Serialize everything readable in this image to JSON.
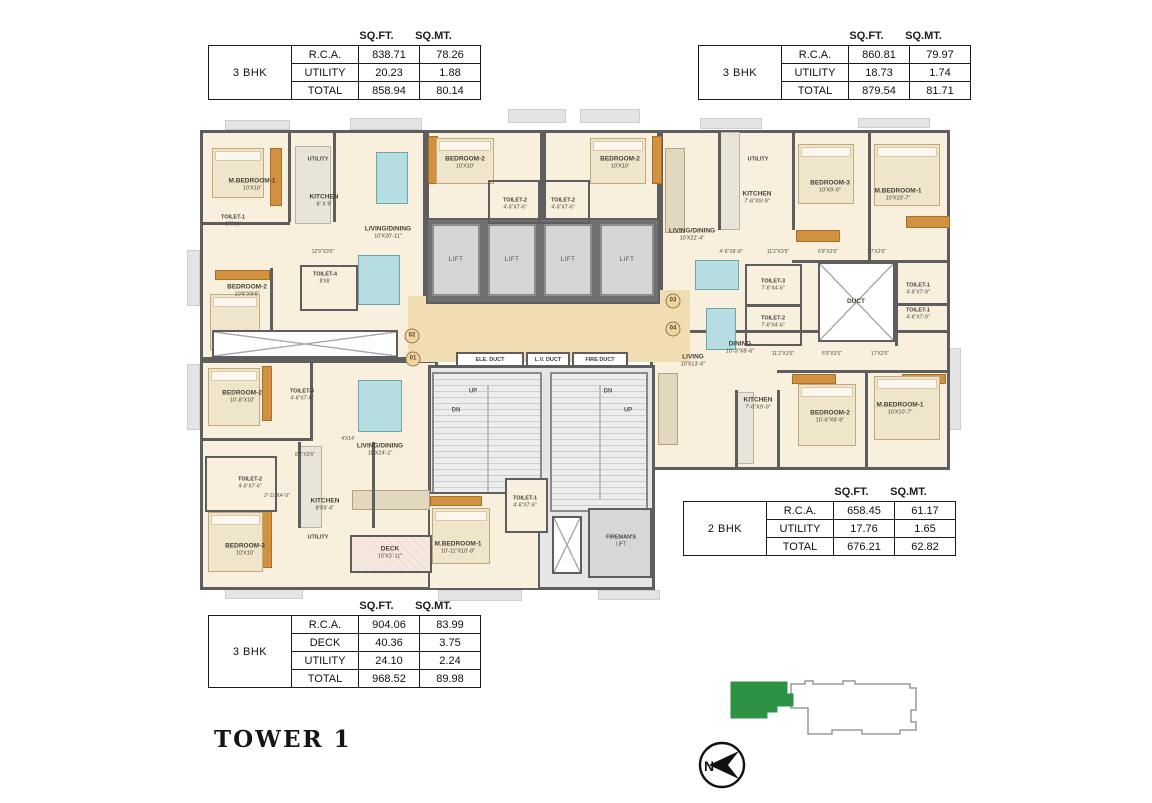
{
  "title": "TOWER 1",
  "compass": {
    "label": "N"
  },
  "colors": {
    "keyplan_green": "#2e9245",
    "wall_gray": "#5e5e5e",
    "lobby_tan": "#f0ddb2"
  },
  "tables": [
    {
      "unit": "3 BHK",
      "headers": [
        "SQ.FT.",
        "SQ.MT."
      ],
      "rows": [
        [
          "R.C.A.",
          "838.71",
          "78.26"
        ],
        [
          "UTILITY",
          "20.23",
          "1.88"
        ],
        [
          "TOTAL",
          "858.94",
          "80.14"
        ]
      ]
    },
    {
      "unit": "3 BHK",
      "headers": [
        "SQ.FT.",
        "SQ.MT."
      ],
      "rows": [
        [
          "R.C.A.",
          "860.81",
          "79.97"
        ],
        [
          "UTILITY",
          "18.73",
          "1.74"
        ],
        [
          "TOTAL",
          "879.54",
          "81.71"
        ]
      ]
    },
    {
      "unit": "2 BHK",
      "headers": [
        "SQ.FT.",
        "SQ.MT."
      ],
      "rows": [
        [
          "R.C.A.",
          "658.45",
          "61.17"
        ],
        [
          "UTILITY",
          "17.76",
          "1.65"
        ],
        [
          "TOTAL",
          "676.21",
          "62.82"
        ]
      ]
    },
    {
      "unit": "3 BHK",
      "headers": [
        "SQ.FT.",
        "SQ.MT."
      ],
      "rows": [
        [
          "R.C.A.",
          "904.06",
          "83.99"
        ],
        [
          "DECK",
          "40.36",
          "3.75"
        ],
        [
          "UTILITY",
          "24.10",
          "2.24"
        ],
        [
          "TOTAL",
          "968.52",
          "89.98"
        ]
      ]
    }
  ],
  "floorplan": {
    "lift_label": "LIFT",
    "ducts": [
      "ELE. DUCT",
      "L.V. DUCT",
      "FIRE DUCT"
    ],
    "labels": [
      {
        "x": 52,
        "y": 67,
        "a": "M.BEDROOM-1",
        "b": "10'X10'"
      },
      {
        "x": 118,
        "y": 42,
        "a": "UTILITY",
        "c": "small"
      },
      {
        "x": 124,
        "y": 83,
        "a": "KITCHEN",
        "b": "8' X 9'"
      },
      {
        "x": 33,
        "y": 103,
        "a": "TOILET-1",
        "b": "6'7\"X4'",
        "c": "small"
      },
      {
        "x": 188,
        "y": 115,
        "a": "LIVING/DINING",
        "b": "10'X20'-11\""
      },
      {
        "x": 123,
        "y": 134,
        "a": "12'9\"X3'6\"",
        "c": "dim"
      },
      {
        "x": 47,
        "y": 173,
        "a": "BEDROOM-2",
        "b": "10'9\"X9'6\""
      },
      {
        "x": 125,
        "y": 160,
        "a": "TOILET-4",
        "b": "8'X6'",
        "c": "small"
      },
      {
        "x": 265,
        "y": 45,
        "a": "BEDROOM-2",
        "b": "10'X10'"
      },
      {
        "x": 315,
        "y": 86,
        "a": "TOILET-2",
        "b": "4'-5\"X7'-6\"",
        "c": "small"
      },
      {
        "x": 363,
        "y": 86,
        "a": "TOILET-2",
        "b": "4'-5\"X7'-6\"",
        "c": "small"
      },
      {
        "x": 420,
        "y": 45,
        "a": "BEDROOM-2",
        "b": "10'X10'"
      },
      {
        "x": 492,
        "y": 117,
        "a": "LIVING/DINING",
        "b": "10'X22'-4\""
      },
      {
        "x": 558,
        "y": 42,
        "a": "UTILITY",
        "c": "small"
      },
      {
        "x": 557,
        "y": 80,
        "a": "KITCHEN",
        "b": "7'-6\"X9'-9\""
      },
      {
        "x": 630,
        "y": 69,
        "a": "BEDROOM-3",
        "b": "10'X9'-9\""
      },
      {
        "x": 698,
        "y": 77,
        "a": "M.BEDROOM-1",
        "b": "10'X10'-7\""
      },
      {
        "x": 531,
        "y": 134,
        "a": "4'-6\"X8'-8\"",
        "c": "dim"
      },
      {
        "x": 578,
        "y": 134,
        "a": "11'2\"X3'5\"",
        "c": "dim"
      },
      {
        "x": 628,
        "y": 134,
        "a": "6'9\"X3'5\"",
        "c": "dim"
      },
      {
        "x": 677,
        "y": 134,
        "a": "17'X2'6\"",
        "c": "dim"
      },
      {
        "x": 573,
        "y": 167,
        "a": "TOILET-3",
        "b": "7'-6\"X4'-6\"",
        "c": "small"
      },
      {
        "x": 573,
        "y": 204,
        "a": "TOILET-2",
        "b": "7'-6\"X4'-6\"",
        "c": "small"
      },
      {
        "x": 656,
        "y": 184,
        "a": "DUCT"
      },
      {
        "x": 718,
        "y": 171,
        "a": "TOILET-1",
        "b": "4'-6\"X7'-9\"",
        "c": "small"
      },
      {
        "x": 718,
        "y": 196,
        "a": "TOILET-1",
        "b": "4'-6\"X7'-9\"",
        "c": "small"
      },
      {
        "x": 493,
        "y": 243,
        "a": "LIVING",
        "b": "10'X13'-6\""
      },
      {
        "x": 540,
        "y": 230,
        "a": "DINING",
        "b": "10'-3\"X8'-6\""
      },
      {
        "x": 583,
        "y": 236,
        "a": "11'2\"X3'5\"",
        "c": "dim"
      },
      {
        "x": 632,
        "y": 236,
        "a": "6'9\"X3'5\"",
        "c": "dim"
      },
      {
        "x": 680,
        "y": 236,
        "a": "17'X2'6\"",
        "c": "dim"
      },
      {
        "x": 558,
        "y": 286,
        "a": "KITCHEN",
        "b": "7'-6\"X9'-9\""
      },
      {
        "x": 630,
        "y": 299,
        "a": "BEDROOM-2",
        "b": "10'-6\"X9'-9\""
      },
      {
        "x": 700,
        "y": 291,
        "a": "M.BEDROOM-1",
        "b": "10'X10'-7\""
      },
      {
        "x": 42,
        "y": 279,
        "a": "BEDROOM-2",
        "b": "10'-8\"X10'"
      },
      {
        "x": 102,
        "y": 277,
        "a": "TOILET-3",
        "b": "4'-6\"X7'-6\"",
        "c": "small"
      },
      {
        "x": 180,
        "y": 332,
        "a": "LIVING/DINING",
        "b": "10'X24'-1\""
      },
      {
        "x": 148,
        "y": 321,
        "a": "4'X14'",
        "c": "dim"
      },
      {
        "x": 105,
        "y": 337,
        "a": "8'5\"X3'6\"",
        "c": "dim"
      },
      {
        "x": 50,
        "y": 365,
        "a": "TOILET-2",
        "b": "4'-6\"X7'-6\"",
        "c": "small"
      },
      {
        "x": 77,
        "y": 378,
        "a": "2'-11\"X4'-9\"",
        "c": "dim"
      },
      {
        "x": 125,
        "y": 387,
        "a": "KITCHEN",
        "b": "8'X9'-6\""
      },
      {
        "x": 118,
        "y": 420,
        "a": "UTILITY",
        "c": "small"
      },
      {
        "x": 45,
        "y": 432,
        "a": "BEDROOM-3",
        "b": "10'X10'"
      },
      {
        "x": 190,
        "y": 435,
        "a": "DECK",
        "b": "10'X3'-11\""
      },
      {
        "x": 273,
        "y": 274,
        "a": "UP",
        "c": "updn"
      },
      {
        "x": 256,
        "y": 293,
        "a": "DN",
        "c": "updn"
      },
      {
        "x": 408,
        "y": 274,
        "a": "DN",
        "c": "updn"
      },
      {
        "x": 428,
        "y": 293,
        "a": "UP",
        "c": "updn"
      },
      {
        "x": 325,
        "y": 384,
        "a": "TOILET-1",
        "b": "4'-6\"X7'-6\"",
        "c": "small"
      },
      {
        "x": 258,
        "y": 430,
        "a": "M.BEDROOM-1",
        "b": "10'-11\"X10'-8\""
      },
      {
        "x": 421,
        "y": 423,
        "a": "FIREMAN'S",
        "b": "LIFT",
        "c": "small"
      },
      {
        "x": 212,
        "y": 218,
        "a": "02",
        "c": "circle"
      },
      {
        "x": 213,
        "y": 241,
        "a": "01",
        "c": "circle"
      },
      {
        "x": 473,
        "y": 183,
        "a": "03",
        "c": "circle"
      },
      {
        "x": 473,
        "y": 211,
        "a": "04",
        "c": "circle"
      }
    ]
  }
}
